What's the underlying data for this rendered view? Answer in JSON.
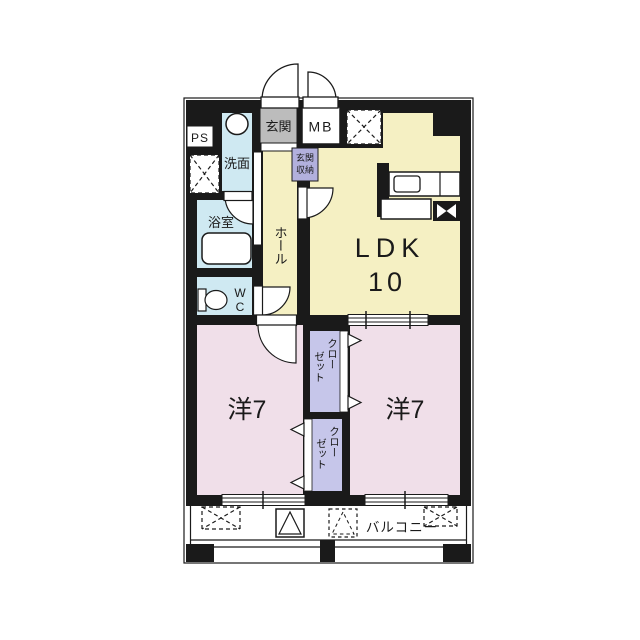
{
  "document": {
    "type": "apartment-floor-plan",
    "orientation": "2-bedroom + LDK unit with south balcony"
  },
  "colors": {
    "wall": "#1a1a1a",
    "ldk_fill": "#f5f0c3",
    "bedroom_fill": "#f0dfe9",
    "wet_area_fill": "#cfe9f2",
    "closet_fill": "#c6c6ea",
    "entrance_storage_fill": "#b2b0dd",
    "entrance_fill": "#bcbcbc",
    "background": "#ffffff"
  },
  "rooms": {
    "entrance": {
      "label": "玄関"
    },
    "meter_box": {
      "label": "MB"
    },
    "pipe_space": {
      "label": "PS"
    },
    "washroom": {
      "label": "洗面"
    },
    "bathroom": {
      "label": "浴室"
    },
    "toilet": {
      "label": "WC"
    },
    "hall": {
      "label": "ホール"
    },
    "entrance_storage": {
      "line1": "玄関",
      "line2": "収納"
    },
    "ldk": {
      "label": "LDK",
      "size": "10"
    },
    "bedroom_left": {
      "label": "洋7"
    },
    "bedroom_right": {
      "label": "洋7"
    },
    "closet_top": {
      "label": "クローゼット",
      "col_right": "クロー",
      "col_left": "ゼット"
    },
    "closet_bottom": {
      "label": "クローゼット",
      "col_right": "クロー",
      "col_left": "ゼット"
    },
    "balcony": {
      "label": "バルコニー"
    }
  }
}
